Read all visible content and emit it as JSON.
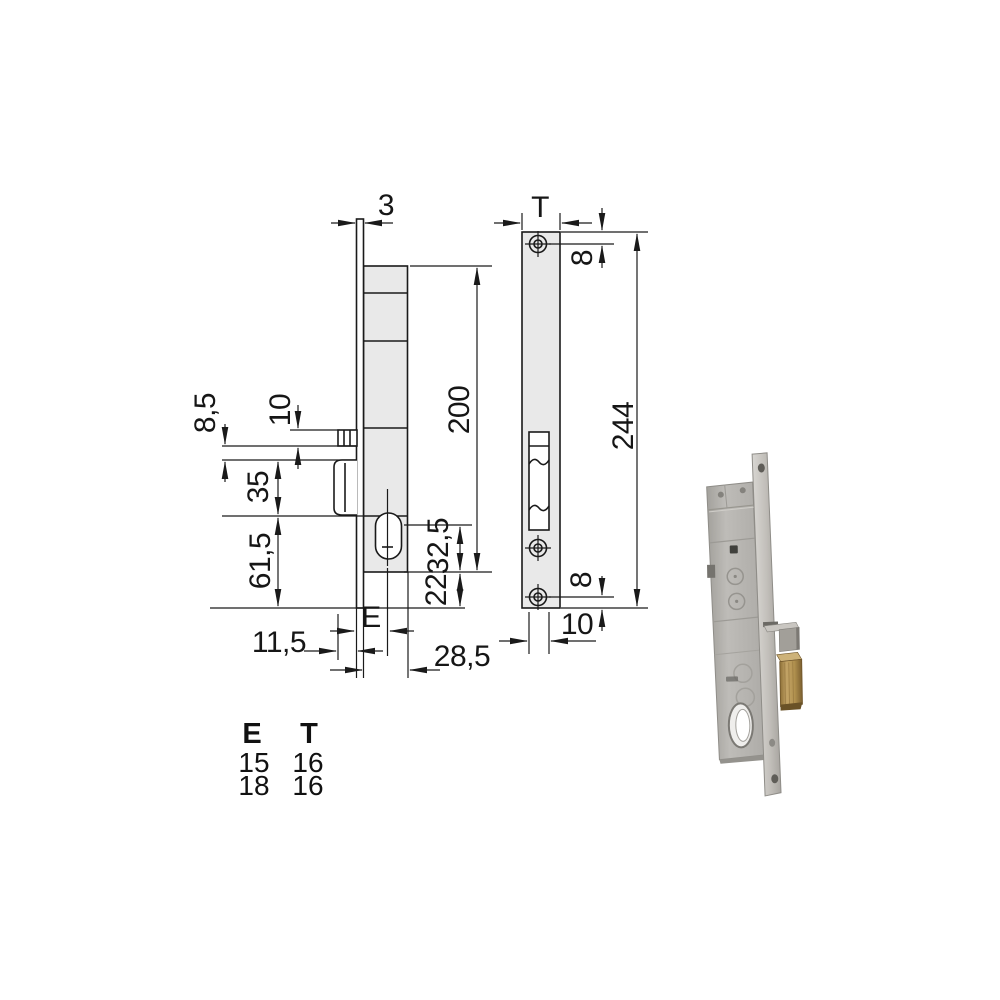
{
  "drawing": {
    "side_view": {
      "plate_thickness": "3",
      "body_height": "200",
      "latch_lip": "8,5",
      "latch_height": "10",
      "mid_section": "35",
      "lower_section": "61,5",
      "cylinder_offset": "32,5",
      "bottom_offset": "22",
      "backset_label": "E",
      "latch_protrusion": "11,5",
      "body_depth": "28,5"
    },
    "front_view": {
      "faceplate_width_label": "T",
      "top_screw_offset": "8",
      "faceplate_height": "244",
      "bottom_screw_offset": "8",
      "screw_edge_offset": "10"
    }
  },
  "table": {
    "col1_header": "E",
    "col2_header": "T",
    "rows": [
      {
        "e": "15",
        "t": "16"
      },
      {
        "e": "18",
        "t": "16"
      }
    ]
  },
  "colors": {
    "line": "#1a1a1a",
    "drawing_fill": "#e9e9e9",
    "photo_zinc": "#b4b2ae",
    "photo_plate": "#c6c4c0",
    "photo_brass": "#b2924f"
  }
}
